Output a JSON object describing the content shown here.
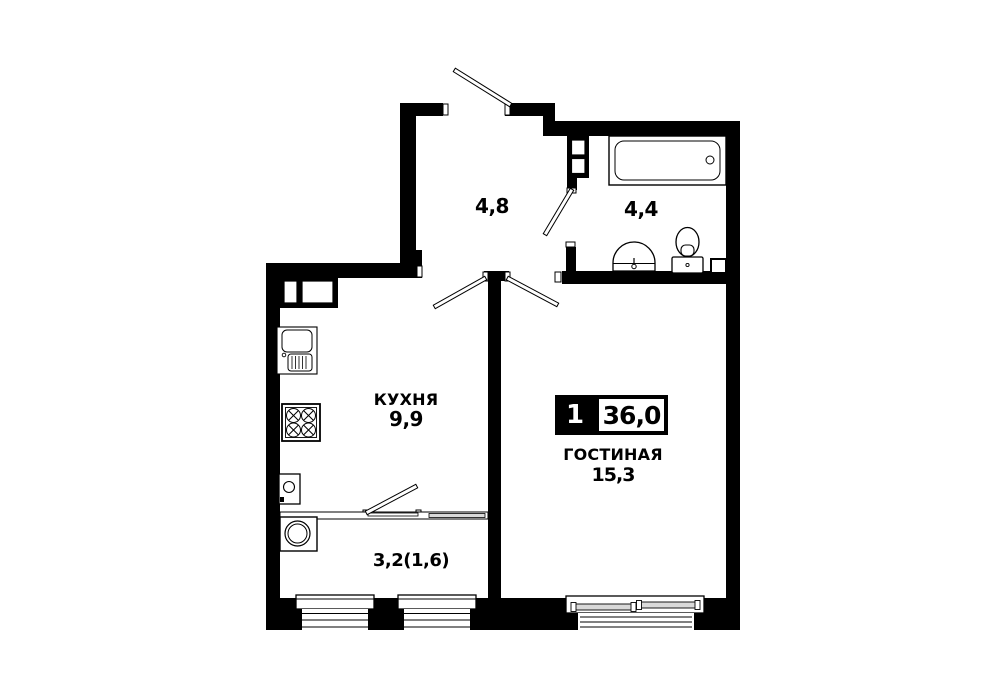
{
  "floor_plan": {
    "badge": {
      "rooms_count": "1",
      "total_area": "36,0"
    },
    "rooms": {
      "hallway": {
        "area": "4,8"
      },
      "bathroom": {
        "area": "4,4"
      },
      "kitchen": {
        "name": "КУХНЯ",
        "area": "9,9"
      },
      "living_room": {
        "name": "ГОСТИНАЯ",
        "area": "15,3"
      },
      "balcony": {
        "area": "3,2(1,6)"
      }
    },
    "colors": {
      "walls": "#000000",
      "background": "#ffffff",
      "fixture_stroke": "#000000",
      "window_sash_fill": "#d9d9d9",
      "badge_bg": "#000000",
      "badge_text": "#ffffff"
    }
  }
}
